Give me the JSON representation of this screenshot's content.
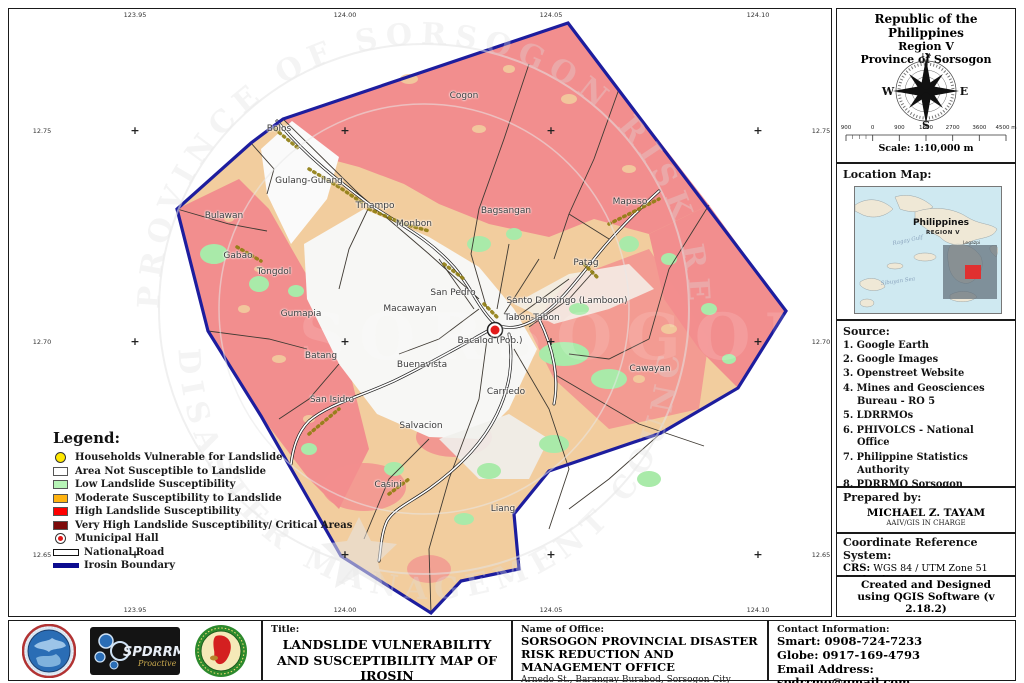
{
  "map": {
    "top_coords": [
      "123.95",
      "124.00",
      "124.05",
      "124.10"
    ],
    "bottom_coords": [
      "123.95",
      "124.00",
      "124.05",
      "124.10"
    ],
    "left_coords": [
      "12.75",
      "12.70",
      "12.65"
    ],
    "right_coords": [
      "12.75",
      "12.70",
      "12.65"
    ],
    "grid_x": [
      126,
      336,
      542,
      749
    ],
    "grid_y": [
      122,
      333,
      546
    ],
    "labels": [
      {
        "text": "Cogon",
        "x": 455,
        "y": 87
      },
      {
        "text": "Bolos",
        "x": 270,
        "y": 120
      },
      {
        "text": "Gulang-Gulang",
        "x": 300,
        "y": 172
      },
      {
        "text": "Tinampo",
        "x": 366,
        "y": 197
      },
      {
        "text": "Monbon",
        "x": 405,
        "y": 215
      },
      {
        "text": "Bagsangan",
        "x": 497,
        "y": 202
      },
      {
        "text": "Mapaso",
        "x": 621,
        "y": 193
      },
      {
        "text": "Bulawan",
        "x": 215,
        "y": 207
      },
      {
        "text": "Gabao",
        "x": 229,
        "y": 247
      },
      {
        "text": "Tongdol",
        "x": 265,
        "y": 263
      },
      {
        "text": "Patag",
        "x": 577,
        "y": 254
      },
      {
        "text": "San Pedro",
        "x": 444,
        "y": 284
      },
      {
        "text": "Santo Domingo (Lamboon)",
        "x": 558,
        "y": 292
      },
      {
        "text": "Macawayan",
        "x": 401,
        "y": 300
      },
      {
        "text": "Tabon-Tabon",
        "x": 523,
        "y": 309
      },
      {
        "text": "Gumapia",
        "x": 292,
        "y": 305
      },
      {
        "text": "Bacalod (Pob.)",
        "x": 481,
        "y": 332
      },
      {
        "text": "Batang",
        "x": 312,
        "y": 347
      },
      {
        "text": "Buenavista",
        "x": 413,
        "y": 356
      },
      {
        "text": "Cawayan",
        "x": 641,
        "y": 360
      },
      {
        "text": "San Isidro",
        "x": 323,
        "y": 391
      },
      {
        "text": "Carriedo",
        "x": 497,
        "y": 383
      },
      {
        "text": "Salvacion",
        "x": 412,
        "y": 417
      },
      {
        "text": "Casini",
        "x": 379,
        "y": 476
      },
      {
        "text": "Liang",
        "x": 494,
        "y": 500
      }
    ],
    "colors": {
      "high_susceptibility": "#f28e8e",
      "moderate_susceptibility": "#f2cd9e",
      "low_susceptibility": "#a9eaa9",
      "not_susceptible": "#fafafa",
      "boundary_blue": "#1d1d9e",
      "household_yellow": "#ffe800"
    }
  },
  "legend": {
    "title": "Legend:",
    "items": [
      {
        "swatch": "circle",
        "color": "#ffe800",
        "label": "Households Vulnerable for Landslide"
      },
      {
        "swatch": "rect",
        "color": "#ffffff",
        "label": "Area Not Susceptible to Landslide"
      },
      {
        "swatch": "rect",
        "color": "#b7f5b7",
        "label": "Low Landslide Susceptibility"
      },
      {
        "swatch": "rect",
        "color": "#ffb310",
        "label": "Moderate Susceptibility to Landslide"
      },
      {
        "swatch": "rect",
        "color": "#ff0000",
        "label": "High Landslide Susceptibility"
      },
      {
        "swatch": "rect",
        "color": "#7d0b0b",
        "label": "Very High Landslide Susceptibility/ Critical Areas"
      },
      {
        "swatch": "hall",
        "color": "#e01818",
        "label": "Municipal Hall"
      },
      {
        "swatch": "road",
        "color": "#ffffff",
        "label": "National Road"
      },
      {
        "swatch": "line",
        "color": "#0b0b8f",
        "label": "Irosin Boundary"
      }
    ]
  },
  "sidebar": {
    "header": {
      "line1": "Republic of the Philippines",
      "line2": "Region V",
      "line3": "Province of Sorsogon"
    },
    "compass": {
      "n": "N",
      "e": "E",
      "s": "S",
      "w": "W"
    },
    "scalebar": {
      "labels": [
        "900",
        "0",
        "900",
        "1800",
        "2700",
        "3600",
        "4500 m"
      ],
      "caption": "Scale: 1:10,000 m"
    },
    "location": {
      "title": "Location Map:",
      "country": "Philippines",
      "region": "REGION V",
      "sea1": "Ragay Gulf",
      "sea2": "Sibuyan Sea",
      "city": "Legazpi"
    },
    "source": {
      "title": "Source:",
      "items": [
        "1. Google Earth",
        "2. Google Images",
        "3. Openstreet Website",
        "4. Mines and Geosciences Bureau - RO 5",
        "5. LDRRMOs",
        "6. PHIVOLCS - National Office",
        "7. Philippine Statistics Authority",
        "8. PDRRMO Sorsogon",
        "9. Provincial Planning Development Office",
        "10. National Mapping and Resource Information Authority (NAMRIA)"
      ]
    },
    "prepared": {
      "title": "Prepared by:",
      "name": "MICHAEL Z. TAYAM",
      "role": "AAIV/GIS IN CHARGE"
    },
    "crs": {
      "title": "Coordinate Reference System:",
      "crs_label": "CRS:",
      "crs_value": "WGS 84 / UTM Zone 51",
      "auth_label": "Authority ID:",
      "auth_value": "ESPG: 32651"
    },
    "credit": "Created and Designed using QGIS Software (v 2.18.2)"
  },
  "footer": {
    "title_label": "Title:",
    "title_value": "LANDSLIDE VULNERABILITY AND SUSCEPTIBILITY MAP OF IROSIN",
    "office_label": "Name of Office:",
    "office_value": "SORSOGON PROVINCIAL DISASTER RISK REDUCTION AND MANAGEMENT OFFICE",
    "office_address": "Arnedo St., Barangay Burabod, Sorsogon City",
    "contact_label": "Contact Information:",
    "smart": "Smart: 0908-724-7233",
    "globe": "Globe: 0917-169-4793",
    "email": "Email Address: spdrrmo@gmail.com",
    "logos": {
      "spdrrmc_text": "SPDRRMC",
      "spdrrmc_sub": "Proactive"
    }
  }
}
